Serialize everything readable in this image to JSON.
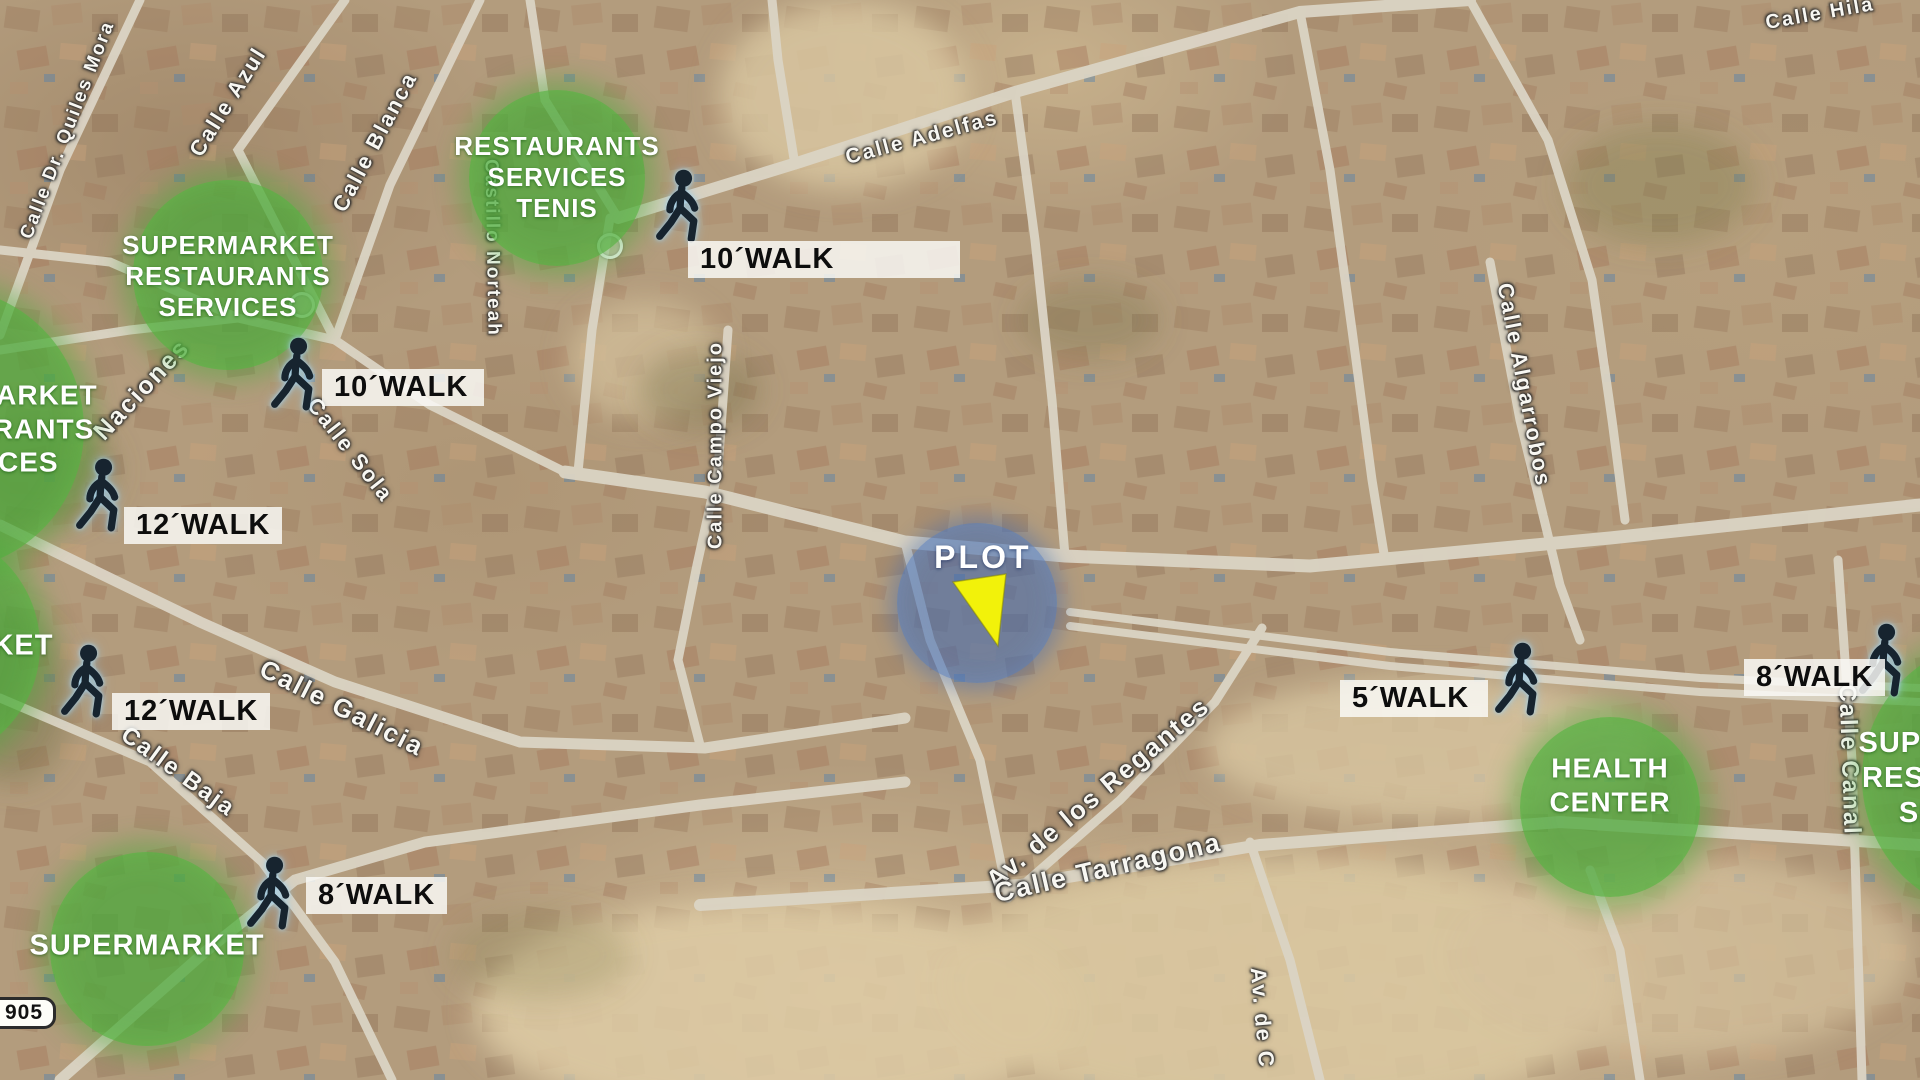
{
  "map": {
    "base_color": "#b39c7d",
    "road_color": "#dbd4c5",
    "amenity_green": "#4aa83a",
    "plot_blue": "#3a66b2",
    "triangle_yellow": "#f2f20a"
  },
  "plot": {
    "label": "PLOT",
    "cx": 977,
    "cy": 603,
    "r": 80,
    "triangle_points": "56,59 109,51 101,123"
  },
  "road_sign": {
    "text": "905"
  },
  "amenities": [
    {
      "id": "restaurants-tenis-nw",
      "lines": [
        "RESTAURANTS",
        "SERVICES",
        "TENIS"
      ],
      "cx": 557,
      "cy": 178,
      "r": 88,
      "font": 26,
      "dx": 0,
      "dy": 0
    },
    {
      "id": "supermarket-nw",
      "lines": [
        "SUPERMARKET",
        "RESTAURANTS",
        "SERVICES"
      ],
      "cx": 228,
      "cy": 275,
      "r": 95,
      "font": 26,
      "dx": 0,
      "dy": 2
    },
    {
      "id": "supermarket-left-mid",
      "lines": [
        "SUPERMARKET",
        "RESTAURANTS",
        "SERVICES"
      ],
      "cx": -58,
      "cy": 429,
      "r": 142,
      "font": 28,
      "dx": 42,
      "dy": 0
    },
    {
      "id": "market-left-lower",
      "lines": [
        "SUPERMARKET"
      ],
      "cx": -78,
      "cy": 646,
      "r": 118,
      "font": 29,
      "dx": 14,
      "dy": 0
    },
    {
      "id": "supermarket-sw",
      "lines": [
        "SUPERMARKET"
      ],
      "cx": 147,
      "cy": 949,
      "r": 97,
      "font": 29,
      "dx": 0,
      "dy": -3
    },
    {
      "id": "health-center",
      "lines": [
        "HEALTH",
        "CENTER"
      ],
      "cx": 1610,
      "cy": 807,
      "r": 90,
      "font": 28,
      "dx": 0,
      "dy": -22
    },
    {
      "id": "supermarket-right-edge",
      "lines": [
        "SUPERMARKET",
        "RESTAURANTS",
        "SERVICES"
      ],
      "cx": 2000,
      "cy": 778,
      "r": 138,
      "font": 29,
      "dx": -24,
      "dy": 0
    }
  ],
  "walks": [
    {
      "id": "walk-10-top",
      "label": "10´WALK",
      "box_left": 688,
      "box_top": 241,
      "box_w": 272,
      "man_cx": 681,
      "man_cy": 209
    },
    {
      "id": "walk-10-left",
      "label": "10´WALK",
      "box_left": 322,
      "box_top": 369,
      "box_w": 162,
      "man_cx": 296,
      "man_cy": 377
    },
    {
      "id": "walk-12-left-upper",
      "label": "12´WALK",
      "box_left": 124,
      "box_top": 507,
      "box_w": 140,
      "man_cx": 101,
      "man_cy": 498
    },
    {
      "id": "walk-12-left-lower",
      "label": "12´WALK",
      "box_left": 112,
      "box_top": 693,
      "box_w": 142,
      "man_cx": 86,
      "man_cy": 684
    },
    {
      "id": "walk-8-sw",
      "label": "8´WALK",
      "box_left": 306,
      "box_top": 877,
      "box_w": 122,
      "man_cx": 272,
      "man_cy": 896
    },
    {
      "id": "walk-5-right",
      "label": "5´WALK",
      "box_left": 1340,
      "box_top": 680,
      "box_w": 148,
      "man_cx": 1520,
      "man_cy": 682
    },
    {
      "id": "walk-8-right",
      "label": "8´WALK",
      "box_left": 1744,
      "box_top": 659,
      "box_w": 120,
      "man_cx": 1884,
      "man_cy": 663
    }
  ],
  "streets": [
    {
      "name": "Calle Dr. Quiles Mora",
      "x": 68,
      "y": 130,
      "rot": -69,
      "size": 19
    },
    {
      "name": "Calle Azul",
      "x": 228,
      "y": 102,
      "rot": -58,
      "size": 22
    },
    {
      "name": "Calle Blanca",
      "x": 375,
      "y": 142,
      "rot": -62,
      "size": 22
    },
    {
      "name": "Calle Adelfas",
      "x": 922,
      "y": 138,
      "rot": -15,
      "size": 21
    },
    {
      "name": "Naciones",
      "x": 142,
      "y": 390,
      "rot": -47,
      "size": 25
    },
    {
      "name": "Castillo Norteah",
      "x": 492,
      "y": 248,
      "rot": 89,
      "size": 19
    },
    {
      "name": "Calle Campo Viejo",
      "x": 716,
      "y": 445,
      "rot": -90,
      "size": 20
    },
    {
      "name": "Calle Sola",
      "x": 350,
      "y": 450,
      "rot": 52,
      "size": 22
    },
    {
      "name": "Calle Galicia",
      "x": 342,
      "y": 708,
      "rot": 27,
      "size": 26
    },
    {
      "name": "Calle Baja",
      "x": 178,
      "y": 772,
      "rot": 36,
      "size": 24
    },
    {
      "name": "Calle Algarrobos",
      "x": 1524,
      "y": 385,
      "rot": 79,
      "size": 22
    },
    {
      "name": "Av. de los Regantes",
      "x": 1098,
      "y": 793,
      "rot": -40,
      "size": 26
    },
    {
      "name": "Calle Tarragona",
      "x": 1108,
      "y": 868,
      "rot": -13,
      "size": 27
    },
    {
      "name": "Calle Canal",
      "x": 1849,
      "y": 760,
      "rot": 88,
      "size": 24
    },
    {
      "name": "Av. de C",
      "x": 1262,
      "y": 1018,
      "rot": 85,
      "size": 22
    },
    {
      "name": "Calle Hila",
      "x": 1820,
      "y": 14,
      "rot": -10,
      "size": 20
    }
  ],
  "poi_markers": [
    {
      "x": 610,
      "y": 246
    },
    {
      "x": 302,
      "y": 305
    }
  ]
}
